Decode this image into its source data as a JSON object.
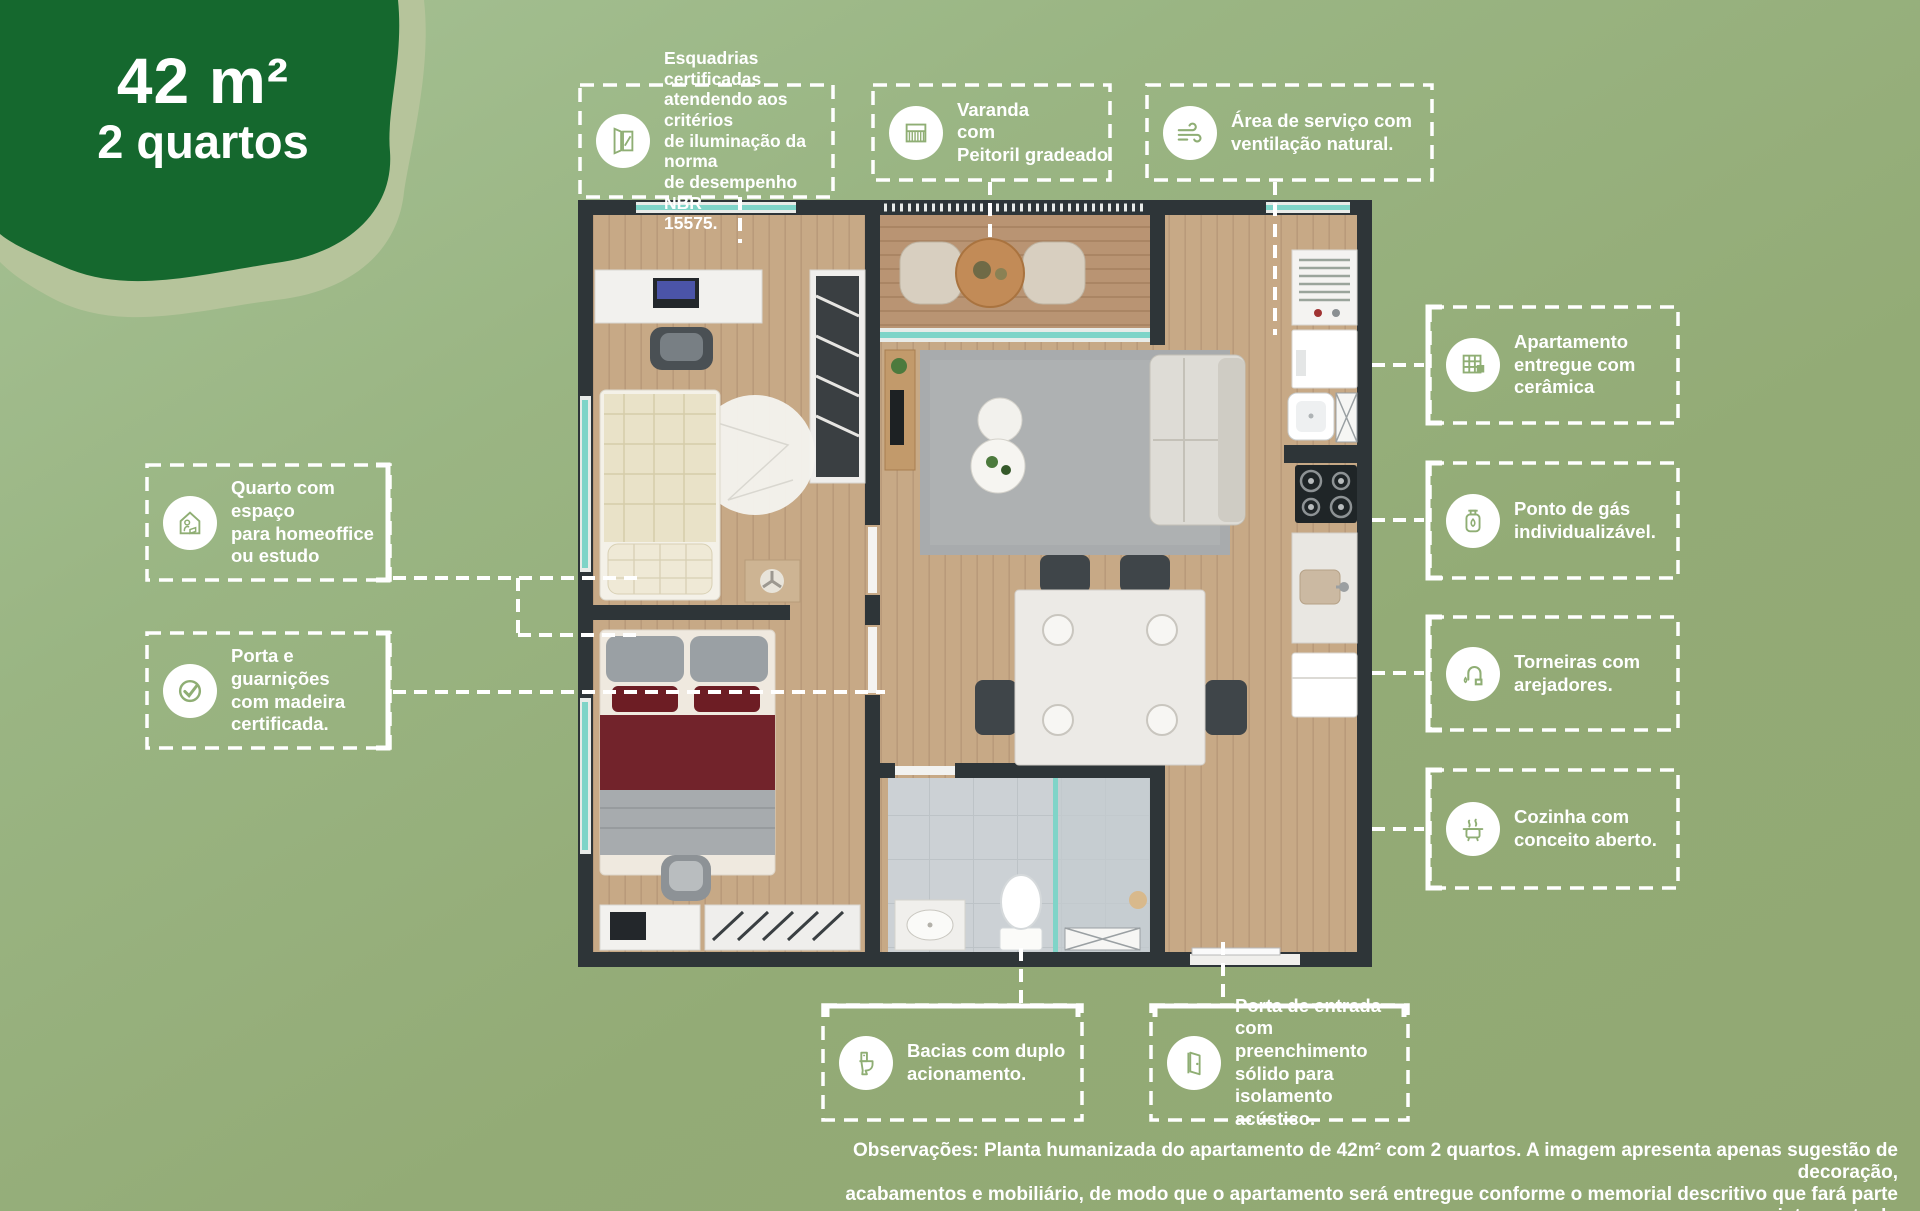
{
  "badge": {
    "area": "42 m²",
    "rooms": "2 quartos"
  },
  "callouts": [
    {
      "id": "esquadrias",
      "icon": "window-icon",
      "lines": [
        "Esquadrias certificadas",
        "atendendo aos critérios",
        "de iluminação da norma",
        "de desempenho NBR",
        "15575."
      ]
    },
    {
      "id": "varanda",
      "icon": "railing-icon",
      "lines": [
        "Varanda",
        "com",
        "Peitoril gradeado"
      ]
    },
    {
      "id": "area-servico",
      "icon": "wind-icon",
      "lines": [
        "Área de serviço com",
        "ventilação natural."
      ]
    },
    {
      "id": "ceramica",
      "icon": "tiles-icon",
      "lines": [
        "Apartamento",
        "entregue com",
        "cerâmica"
      ]
    },
    {
      "id": "gas",
      "icon": "gas-cylinder-icon",
      "lines": [
        "Ponto de gás",
        "individualizável."
      ]
    },
    {
      "id": "torneiras",
      "icon": "faucet-icon",
      "lines": [
        "Torneiras com",
        "arejadores."
      ]
    },
    {
      "id": "cozinha",
      "icon": "pot-icon",
      "lines": [
        "Cozinha com",
        "conceito aberto."
      ]
    },
    {
      "id": "quarto-homeoffice",
      "icon": "homeoffice-icon",
      "lines": [
        "Quarto com espaço",
        "para homeoffice",
        "ou estudo"
      ]
    },
    {
      "id": "porta-madeira",
      "icon": "check-icon",
      "lines": [
        "Porta e guarnições",
        "com madeira",
        "certificada."
      ]
    },
    {
      "id": "bacias",
      "icon": "toilet-icon",
      "lines": [
        "Bacias com duplo",
        "acionamento."
      ]
    },
    {
      "id": "porta-entrada",
      "icon": "door-icon",
      "lines": [
        "Porta de entrada",
        "com preenchimento",
        "sólido para",
        "isolamento acústico."
      ]
    }
  ],
  "disclaimer": {
    "lines": [
      "Observações: Planta humanizada do apartamento de 42m² com 2 quartos. A imagem apresenta apenas sugestão de decoração,",
      "acabamentos e mobiliário, de modo que o apartamento será entregue conforme o memorial descritivo que fará parte integrante do",
      "instrumento de compra e venda."
    ]
  },
  "colors": {
    "background_top": "#a6c295",
    "background_bottom": "#92a873",
    "badge_green": "#15682e",
    "badge_sage": "#b6c49b",
    "callout_white": "#ffffff",
    "wall": "#2e3538",
    "wood": "#c7a986",
    "glass": "#7fd4c8",
    "bath_tile": "#ccd1d5"
  }
}
